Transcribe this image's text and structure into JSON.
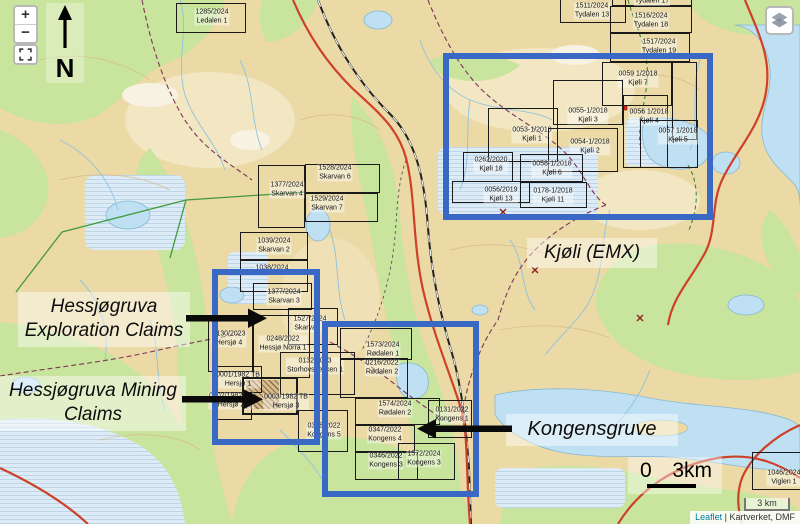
{
  "controls": {
    "zoom_in": "+",
    "zoom_out": "−",
    "scale_label": "3 km",
    "attribution": {
      "leaflet": "Leaflet",
      "separator": " | ",
      "sources": "Kartverket, DMF"
    }
  },
  "compass": {
    "north_label": "N"
  },
  "annotations": {
    "exploration_claims": {
      "line1": "Hessjøgruva",
      "line2": "Exploration Claims"
    },
    "mining_claims": {
      "line1": "Hessjøgruva Mining",
      "line2": "Claims"
    },
    "kjoli_emx": "Kjøli (EMX)",
    "kongensgruve": "Kongensgruve",
    "scale_zero": "0",
    "scale_distance": "3km"
  },
  "colors": {
    "highlight_blue": "#3a68c5",
    "claim_border": "#1a1a1a",
    "water_blue": "#bfe0f2",
    "vegetation_green": "#c9e49c",
    "terrain_tan": "#ebd9a6",
    "road_red": "#cd4129"
  },
  "claims": [
    {
      "num": "1285/2024",
      "name": "Ledalen 1",
      "box": [
        176,
        3,
        70,
        30
      ],
      "label": [
        212,
        17
      ]
    },
    {
      "num": "1511/2024",
      "name": "Tydalen 13",
      "box": [
        560,
        -14,
        66,
        37
      ],
      "label": [
        592,
        11
      ]
    },
    {
      "num": "",
      "name": "Tydalen 17",
      "box": [
        612,
        -22,
        80,
        28
      ],
      "label": [
        652,
        2
      ]
    },
    {
      "num": "1516/2024",
      "name": "Tydalen 18",
      "box": [
        610,
        6,
        82,
        27
      ],
      "label": [
        651,
        21
      ]
    },
    {
      "num": "1517/2024",
      "name": "Tydalen 19",
      "box": [
        610,
        33,
        80,
        29
      ],
      "label": [
        659,
        47
      ]
    },
    {
      "num": "0059 1/2018",
      "name": "Kjøli 7",
      "box": [
        602,
        62,
        70,
        44
      ],
      "label": [
        638,
        79
      ]
    },
    {
      "num": "",
      "name": "",
      "box": [
        672,
        62,
        25,
        78
      ]
    },
    {
      "num": "0055-1/2018",
      "name": "Kjøli 3",
      "box": [
        553,
        80,
        70,
        45
      ],
      "label": [
        588,
        116
      ]
    },
    {
      "num": "0056 1/2018",
      "name": "Kjøli 4",
      "box": [
        623,
        95,
        45,
        73
      ],
      "label": [
        649,
        117
      ]
    },
    {
      "num": "0057 1/2018",
      "name": "Kjøli 5",
      "box": [
        640,
        120,
        58,
        48
      ],
      "label": [
        678,
        136
      ]
    },
    {
      "num": "0053-1/2018",
      "name": "Kjøli 1",
      "box": [
        488,
        108,
        70,
        54
      ],
      "label": [
        532,
        135
      ]
    },
    {
      "num": "0054-1/2018",
      "name": "Kjøli 2",
      "box": [
        548,
        128,
        70,
        44
      ],
      "label": [
        590,
        147
      ]
    },
    {
      "num": "0262/2020",
      "name": "Kjøli 18",
      "box": [
        463,
        152,
        50,
        30
      ],
      "label": [
        491,
        165
      ]
    },
    {
      "num": "0058-1/2018",
      "name": "Kjøli 6",
      "box": [
        520,
        154,
        63,
        28
      ],
      "label": [
        552,
        169
      ]
    },
    {
      "num": "0056/2019",
      "name": "Kjøli 13",
      "box": [
        452,
        181,
        78,
        22
      ],
      "label": [
        501,
        195
      ]
    },
    {
      "num": "0178-1/2018",
      "name": "Kjøli 11",
      "box": [
        520,
        182,
        67,
        26
      ],
      "label": [
        553,
        196
      ]
    },
    {
      "num": "1528/2024",
      "name": "Skarvan 6",
      "box": [
        305,
        164,
        75,
        29
      ],
      "label": [
        335,
        173
      ]
    },
    {
      "num": "1377/2024",
      "name": "Skarvan 4",
      "box": [
        258,
        165,
        47,
        63
      ],
      "label": [
        287,
        190
      ]
    },
    {
      "num": "1529/2024",
      "name": "Skarvan 7",
      "box": [
        305,
        193,
        73,
        29
      ],
      "label": [
        327,
        204
      ]
    },
    {
      "num": "1039/2024",
      "name": "Skarvan 2",
      "box": [
        240,
        232,
        68,
        28
      ],
      "label": [
        274,
        246
      ]
    },
    {
      "num": "1038/2024",
      "name": "",
      "box": [
        240,
        260,
        68,
        32
      ],
      "label": [
        272,
        269
      ]
    },
    {
      "num": "1377/2024",
      "name": "Skarvan 3",
      "box": [
        253,
        283,
        59,
        27
      ],
      "label": [
        284,
        297
      ]
    },
    {
      "num": "1527/2024",
      "name": "Skarvan 5",
      "box": [
        288,
        308,
        50,
        37
      ],
      "label": [
        310,
        324
      ]
    },
    {
      "num": "0130/2023",
      "name": "Hersjø 4",
      "box": [
        208,
        318,
        45,
        54
      ],
      "label": [
        229,
        339
      ]
    },
    {
      "num": "0248/2022",
      "name": "Hessjø Norra 1",
      "box": [
        253,
        315,
        57,
        63
      ],
      "label": [
        283,
        344
      ]
    },
    {
      "num": "0132/2023",
      "name": "Storhovsbekken 1",
      "box": [
        280,
        352,
        75,
        43
      ],
      "label": [
        315,
        366
      ]
    },
    {
      "num": "0001/1982 TB",
      "name": "Hersjø 1",
      "box": [
        215,
        366,
        47,
        27
      ],
      "label": [
        238,
        380
      ]
    },
    {
      "num": "0002/1982 TB",
      "name": "Hersjø 2",
      "box": [
        212,
        392,
        40,
        28
      ],
      "label": [
        231,
        401
      ]
    },
    {
      "num": "0003/1982 TB",
      "name": "Hersjø 3",
      "box": [
        242,
        377,
        56,
        38
      ],
      "bold": true,
      "label": [
        286,
        402
      ]
    },
    {
      "num": "0348/2022",
      "name": "Kongens 5",
      "box": [
        298,
        410,
        50,
        42
      ],
      "label": [
        324,
        431
      ]
    },
    {
      "num": "1573/2024",
      "name": "Rødalen 1",
      "box": [
        340,
        328,
        72,
        32
      ],
      "label": [
        383,
        350
      ]
    },
    {
      "num": "0216/2022",
      "name": "Rødalen 2",
      "box": [
        340,
        358,
        68,
        40
      ],
      "label": [
        382,
        368
      ]
    },
    {
      "num": "1574/2024",
      "name": "Rødalen 2",
      "box": [
        355,
        398,
        85,
        27
      ],
      "label": [
        395,
        409
      ]
    },
    {
      "num": "0347/2022",
      "name": "Kongens 4",
      "box": [
        355,
        425,
        60,
        27
      ],
      "label": [
        385,
        435
      ]
    },
    {
      "num": "0346/2022",
      "name": "Kongens 3",
      "box": [
        355,
        452,
        63,
        28
      ],
      "label": [
        386,
        461
      ]
    },
    {
      "num": "1572/2024",
      "name": "Kongens 3",
      "box": [
        398,
        443,
        57,
        37
      ],
      "label": [
        424,
        459
      ]
    },
    {
      "num": "0131/2022",
      "name": "Kongens 1",
      "box": [
        428,
        400,
        44,
        38
      ],
      "label": [
        452,
        415
      ]
    },
    {
      "num": "1046/2024",
      "name": "Viglen 1",
      "box": [
        752,
        452,
        60,
        38
      ],
      "label": [
        784,
        478
      ]
    }
  ]
}
